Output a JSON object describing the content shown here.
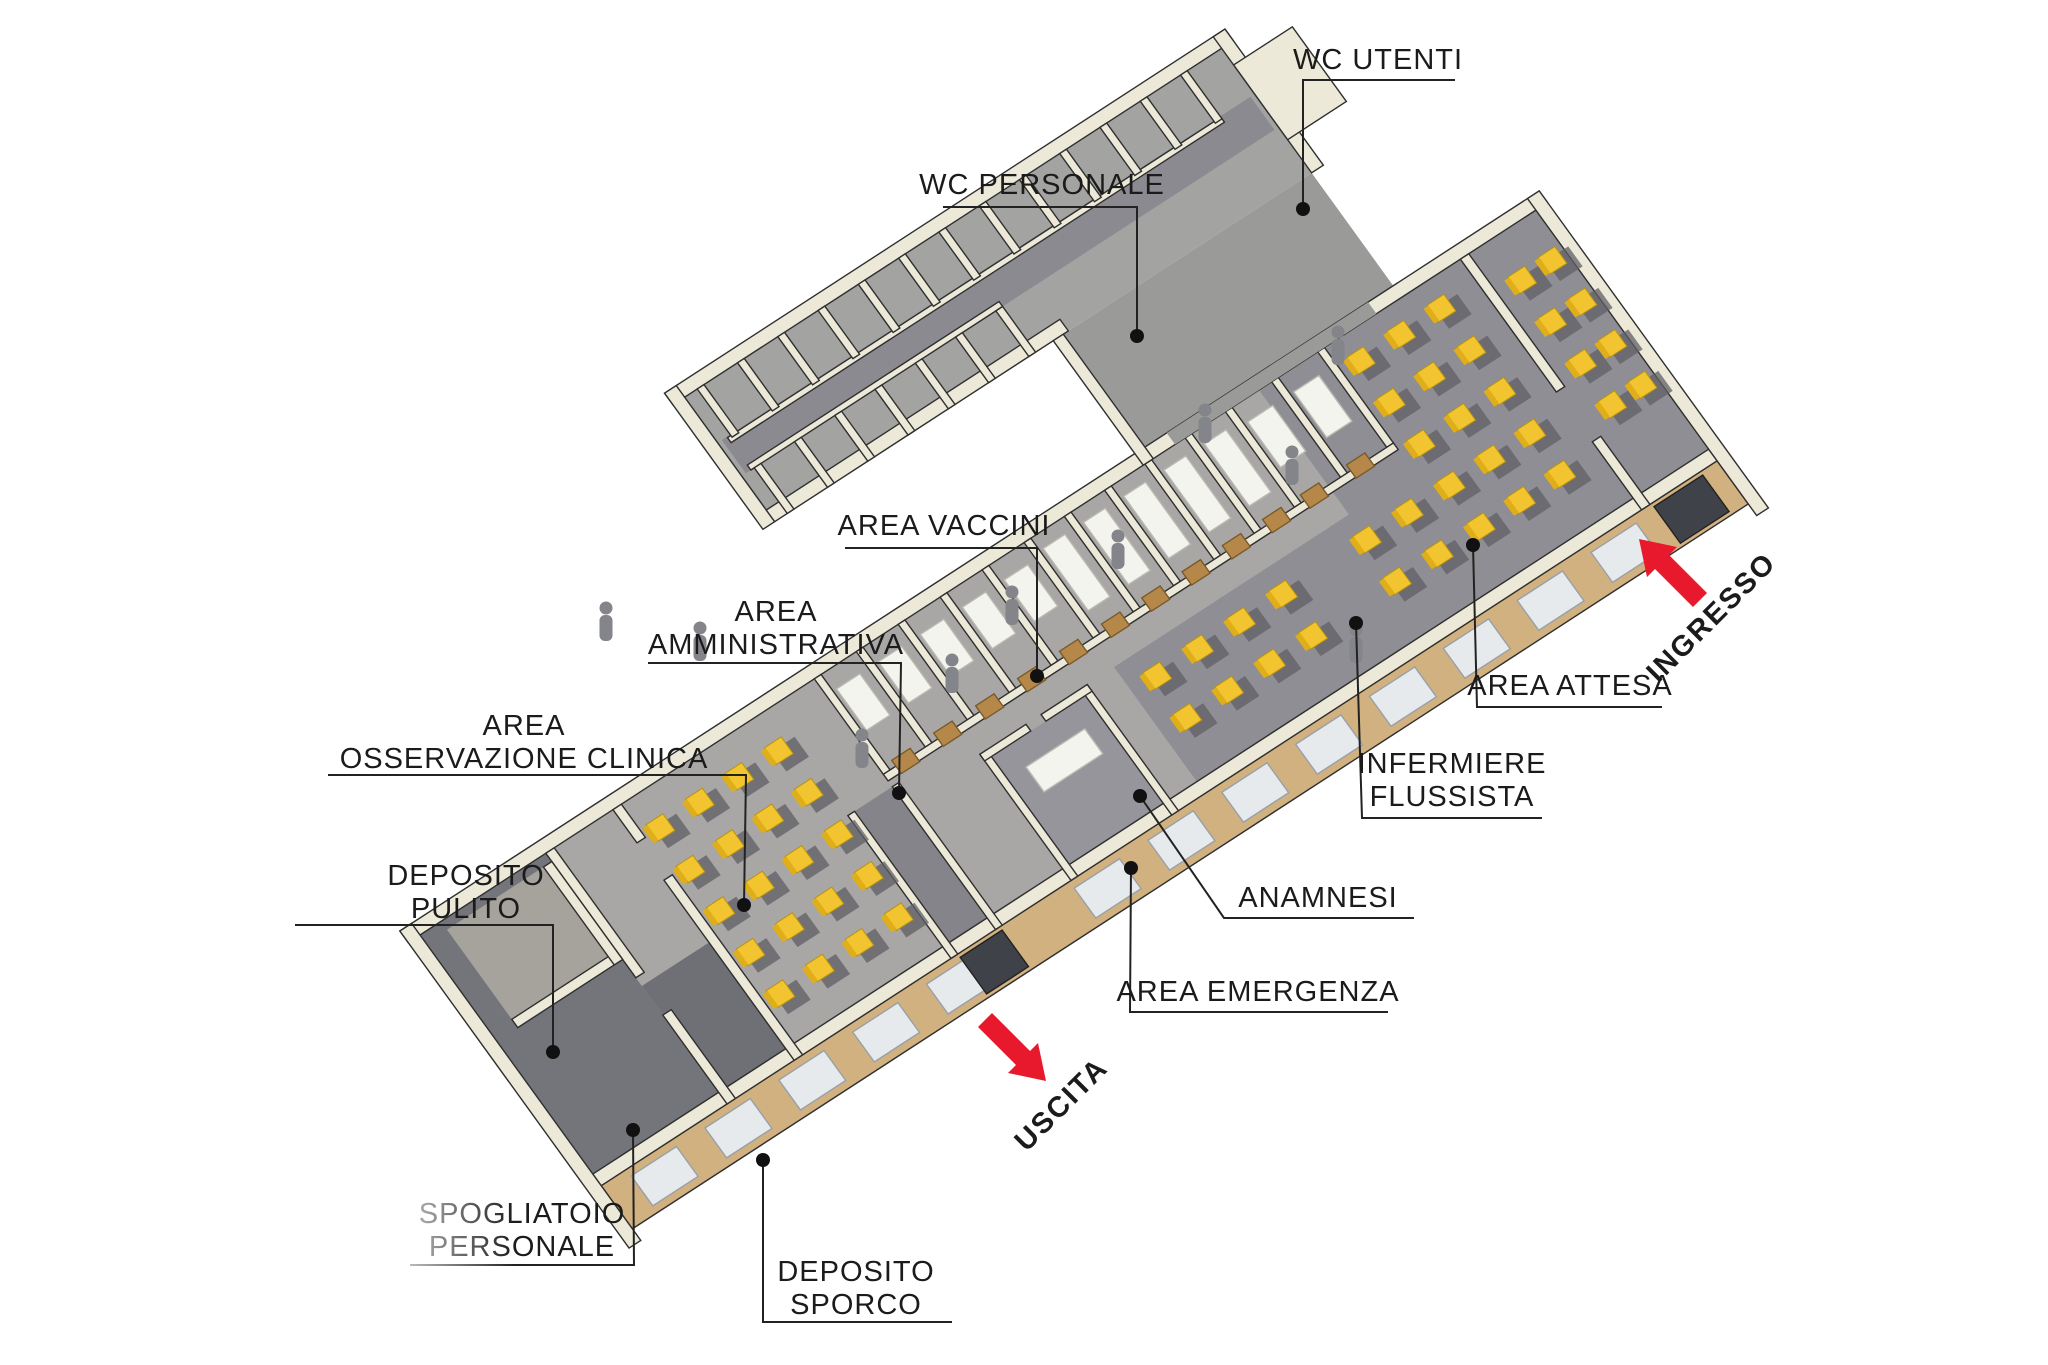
{
  "diagram": {
    "kind": "axonometric-floorplan-render",
    "background": "#ffffff"
  },
  "colors": {
    "wall": "#ece9d8",
    "wall_edge": "#2f2f2f",
    "floor_light": "#a8a7a5",
    "floor_mid": "#8e8e94",
    "floor_dark": "#74747b",
    "corridor": "#84848a",
    "facade_tan": "#d2b180",
    "window": "#e7eaec",
    "door_tan": "#b5884a",
    "door_dark": "#3f4248",
    "chair_yellow": "#f1c430",
    "chair_shadow": "#5f5f66",
    "person_gray": "#84848b",
    "arrow_red": "#e8192c",
    "annotation_line": "#222222"
  },
  "annotations": {
    "wc_utenti": {
      "text": "WC UTENTI"
    },
    "wc_personale": {
      "text": "WC PERSONALE"
    },
    "area_vaccini": {
      "text": "AREA VACCINI"
    },
    "area_amministrativa": {
      "line1": "AREA",
      "line2": "AMMINISTRATIVA"
    },
    "area_osservazione": {
      "line1": "AREA",
      "line2": "OSSERVAZIONE CLINICA"
    },
    "deposito_pulito": {
      "line1": "DEPOSITO",
      "line2": "PULITO"
    },
    "spogliatoio": {
      "line1": "SPOGLIATOIO",
      "line2": "PERSONALE"
    },
    "deposito_sporco": {
      "line1": "DEPOSITO",
      "line2": "SPORCO"
    },
    "area_attesa": {
      "text": "AREA ATTESA"
    },
    "infermiere_flussista": {
      "line1": "INFERMIERE",
      "line2": "FLUSSISTA"
    },
    "anamnesi": {
      "text": "ANAMNESI"
    },
    "area_emergenza": {
      "text": "AREA EMERGENZA"
    },
    "ingresso": {
      "text": "INGRESSO"
    },
    "uscita": {
      "text": "USCITA"
    }
  }
}
